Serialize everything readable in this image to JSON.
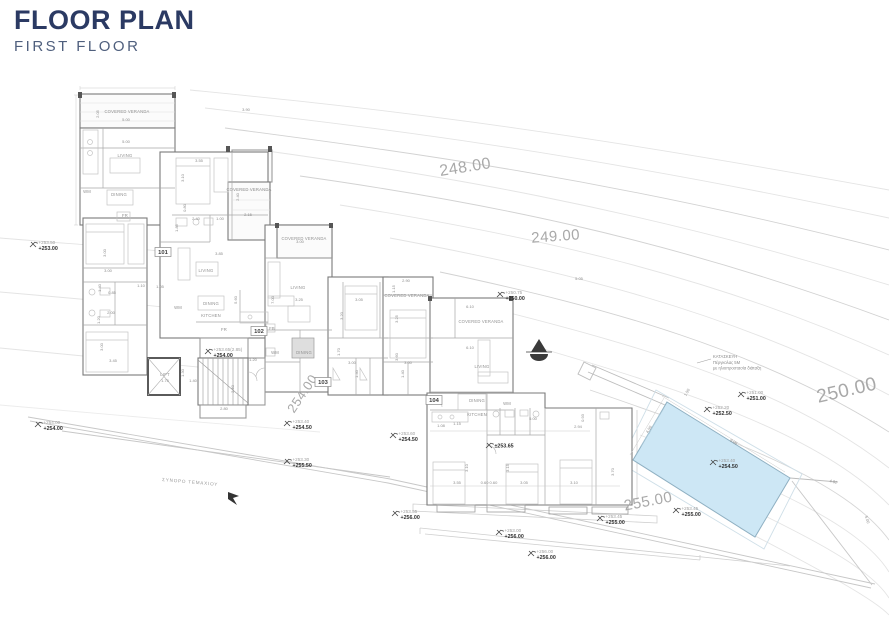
{
  "header": {
    "title": "FLOOR PLAN",
    "subtitle": "FIRST FLOOR"
  },
  "colors": {
    "title": "#2b3a63",
    "subtitle": "#4f5f7d",
    "pool_fill": "#cde7f5",
    "pool_stroke": "#8fb0c2",
    "contour_line": "#e2e2e2",
    "contour_label": "#a9a9a9",
    "wall": "#7a7a7a",
    "spot_existing": "#9e9e9e",
    "spot_proposed": "#2f2f2f",
    "annotation_gray": "#8f8f8f"
  },
  "plan": {
    "contour_labels": [
      {
        "text": "248.00",
        "x": 466,
        "y": 172,
        "rot": -9,
        "size": 16
      },
      {
        "text": "249.00",
        "x": 556,
        "y": 241,
        "rot": -4,
        "size": 15
      },
      {
        "text": "250.00",
        "x": 848,
        "y": 396,
        "rot": -13,
        "size": 19
      },
      {
        "text": "254.00",
        "x": 306,
        "y": 396,
        "rot": -56,
        "size": 13
      },
      {
        "text": "255.00",
        "x": 649,
        "y": 506,
        "rot": -11,
        "size": 15
      }
    ],
    "unit_labels": [
      {
        "text": "101",
        "x": 163,
        "y": 254
      },
      {
        "text": "102",
        "x": 259,
        "y": 333
      },
      {
        "text": "103",
        "x": 323,
        "y": 384
      },
      {
        "text": "104",
        "x": 434,
        "y": 402
      }
    ],
    "room_labels": [
      {
        "text": "COVERED VERANDA",
        "x": 127,
        "y": 113
      },
      {
        "text": "LIVING",
        "x": 125,
        "y": 157
      },
      {
        "text": "DINING",
        "x": 119,
        "y": 196
      },
      {
        "text": "COVERED VERANDA",
        "x": 249,
        "y": 191
      },
      {
        "text": "LIVING",
        "x": 206,
        "y": 272
      },
      {
        "text": "DINING",
        "x": 211,
        "y": 305
      },
      {
        "text": "KITCHEN",
        "x": 211,
        "y": 317
      },
      {
        "text": "COVERED VERANDA",
        "x": 304,
        "y": 240
      },
      {
        "text": "LIVING",
        "x": 298,
        "y": 289
      },
      {
        "text": "DINING",
        "x": 304,
        "y": 354
      },
      {
        "text": "COVERED VERANDA",
        "x": 407,
        "y": 297
      },
      {
        "text": "COVERED VERANDA",
        "x": 481,
        "y": 323
      },
      {
        "text": "LIVING",
        "x": 482,
        "y": 368
      },
      {
        "text": "DINING",
        "x": 477,
        "y": 402
      },
      {
        "text": "KITCHEN",
        "x": 477,
        "y": 416
      },
      {
        "text": "LIFT",
        "x": 165,
        "y": 376
      },
      {
        "text": "WM",
        "x": 87,
        "y": 193
      },
      {
        "text": "FR",
        "x": 125,
        "y": 217
      },
      {
        "text": "WM",
        "x": 178,
        "y": 309
      },
      {
        "text": "FR",
        "x": 224,
        "y": 331
      },
      {
        "text": "FB",
        "x": 272,
        "y": 330
      },
      {
        "text": "WM",
        "x": 275,
        "y": 354
      },
      {
        "text": "WM",
        "x": 507,
        "y": 405
      }
    ],
    "dimension_labels": [
      {
        "text": "5.00",
        "x": 126,
        "y": 121
      },
      {
        "text": "5.00",
        "x": 126,
        "y": 143
      },
      {
        "text": "2.05",
        "x": 99,
        "y": 114,
        "rot": -90
      },
      {
        "text": "3.90",
        "x": 246,
        "y": 111
      },
      {
        "text": "3.55",
        "x": 199,
        "y": 162
      },
      {
        "text": "3.10",
        "x": 184,
        "y": 178,
        "rot": -90
      },
      {
        "text": "2.40",
        "x": 239,
        "y": 197,
        "rot": -90
      },
      {
        "text": "2.15",
        "x": 248,
        "y": 216
      },
      {
        "text": "2.40",
        "x": 196,
        "y": 220
      },
      {
        "text": "1.00",
        "x": 220,
        "y": 220
      },
      {
        "text": "1.85",
        "x": 178,
        "y": 228,
        "rot": -90
      },
      {
        "text": "0.80",
        "x": 186,
        "y": 208,
        "rot": -90
      },
      {
        "text": "3.85",
        "x": 219,
        "y": 255
      },
      {
        "text": "3.00",
        "x": 106,
        "y": 253,
        "rot": -90
      },
      {
        "text": "3.00",
        "x": 108,
        "y": 272
      },
      {
        "text": "1.40",
        "x": 101,
        "y": 288,
        "rot": -90
      },
      {
        "text": "0.85",
        "x": 112,
        "y": 294
      },
      {
        "text": "1.20",
        "x": 100,
        "y": 320,
        "rot": -90
      },
      {
        "text": "2.00",
        "x": 111,
        "y": 314
      },
      {
        "text": "3.45",
        "x": 113,
        "y": 362
      },
      {
        "text": "3.00",
        "x": 103,
        "y": 347,
        "rot": -90
      },
      {
        "text": "1.10",
        "x": 141,
        "y": 287
      },
      {
        "text": "1.05",
        "x": 160,
        "y": 288
      },
      {
        "text": "5.60",
        "x": 237,
        "y": 300,
        "rot": -90
      },
      {
        "text": "3.00",
        "x": 300,
        "y": 243
      },
      {
        "text": "3.25",
        "x": 299,
        "y": 301
      },
      {
        "text": "7.00",
        "x": 274,
        "y": 300,
        "rot": -90
      },
      {
        "text": "3.05",
        "x": 359,
        "y": 301
      },
      {
        "text": "3.20",
        "x": 343,
        "y": 316,
        "rot": -90
      },
      {
        "text": "2.90",
        "x": 406,
        "y": 282
      },
      {
        "text": "1.15",
        "x": 395,
        "y": 289,
        "rot": -90
      },
      {
        "text": "3.25",
        "x": 398,
        "y": 319,
        "rot": -90
      },
      {
        "text": "1.70",
        "x": 340,
        "y": 352,
        "rot": -90
      },
      {
        "text": "3.60",
        "x": 398,
        "y": 357,
        "rot": -90
      },
      {
        "text": "3.00",
        "x": 352,
        "y": 364
      },
      {
        "text": "1.40",
        "x": 358,
        "y": 374,
        "rot": -90
      },
      {
        "text": "3.00",
        "x": 408,
        "y": 364
      },
      {
        "text": "1.40",
        "x": 404,
        "y": 374,
        "rot": -90
      },
      {
        "text": "2.50",
        "x": 234,
        "y": 389,
        "rot": -90
      },
      {
        "text": "2.80",
        "x": 224,
        "y": 410
      },
      {
        "text": "1.40",
        "x": 193,
        "y": 382
      },
      {
        "text": "1.75",
        "x": 165,
        "y": 382
      },
      {
        "text": "1.30",
        "x": 184,
        "y": 373,
        "rot": -90
      },
      {
        "text": "1.20",
        "x": 253,
        "y": 361
      },
      {
        "text": "6.10",
        "x": 470,
        "y": 308
      },
      {
        "text": "6.10",
        "x": 470,
        "y": 349
      },
      {
        "text": "5.05",
        "x": 579,
        "y": 280
      },
      {
        "text": "5.00",
        "x": 533,
        "y": 420
      },
      {
        "text": "2.94",
        "x": 578,
        "y": 428
      },
      {
        "text": "0.93",
        "x": 584,
        "y": 418,
        "rot": -90
      },
      {
        "text": "1.08",
        "x": 441,
        "y": 427
      },
      {
        "text": "1.15",
        "x": 457,
        "y": 425
      },
      {
        "text": "3.55",
        "x": 457,
        "y": 484
      },
      {
        "text": "0.60 0.60",
        "x": 489,
        "y": 484
      },
      {
        "text": "3.05",
        "x": 524,
        "y": 484
      },
      {
        "text": "3.10",
        "x": 574,
        "y": 484
      },
      {
        "text": "3.70",
        "x": 614,
        "y": 472,
        "rot": -90
      },
      {
        "text": "3.15",
        "x": 509,
        "y": 468,
        "rot": -90
      },
      {
        "text": "3.10",
        "x": 468,
        "y": 468,
        "rot": -90
      },
      {
        "text": "9.00",
        "x": 733,
        "y": 443,
        "rot": 31
      },
      {
        "text": "4.50",
        "x": 650,
        "y": 430,
        "rot": -60
      },
      {
        "text": "1.50",
        "x": 688,
        "y": 393,
        "rot": -60
      },
      {
        "text": "4.92",
        "x": 833,
        "y": 483,
        "rot": 14
      },
      {
        "text": "5.00",
        "x": 866,
        "y": 520,
        "rot": 72
      }
    ],
    "spot_elevations": [
      {
        "x": 33,
        "y": 245,
        "existing": "+253.50",
        "proposed": "+253.00"
      },
      {
        "x": 38,
        "y": 425,
        "existing": "+254.00",
        "proposed": "+254.00"
      },
      {
        "x": 208,
        "y": 352,
        "existing": "+253.65(2.85)",
        "proposed": "+254.00"
      },
      {
        "x": 500,
        "y": 295,
        "existing": "+250.75",
        "proposed": "+250.00"
      },
      {
        "x": 287,
        "y": 424,
        "existing": "+253.40",
        "proposed": "+254.50"
      },
      {
        "x": 393,
        "y": 436,
        "existing": "+253.60",
        "proposed": "+254.50"
      },
      {
        "x": 287,
        "y": 462,
        "existing": "+253.30",
        "proposed": "+255.50"
      },
      {
        "x": 489,
        "y": 446,
        "existing": "",
        "proposed": "±253.65"
      },
      {
        "x": 741,
        "y": 395,
        "existing": "+251.00",
        "proposed": "+251.00"
      },
      {
        "x": 707,
        "y": 410,
        "existing": "+252.20",
        "proposed": "+252.50"
      },
      {
        "x": 713,
        "y": 463,
        "existing": "+253.40",
        "proposed": "+254.50"
      },
      {
        "x": 676,
        "y": 511,
        "existing": "+253.45",
        "proposed": "+255.00"
      },
      {
        "x": 600,
        "y": 519,
        "existing": "+253.45",
        "proposed": "+255.00"
      },
      {
        "x": 395,
        "y": 514,
        "existing": "+253.55",
        "proposed": "+256.00"
      },
      {
        "x": 499,
        "y": 533,
        "existing": "+253.00",
        "proposed": "+256.00"
      },
      {
        "x": 531,
        "y": 554,
        "existing": "+256.00",
        "proposed": "+256.00"
      }
    ],
    "notes": {
      "pool_note": {
        "x": 713,
        "y": 358,
        "lines": [
          "ΚΑΤΑΣΚΕΥΗ",
          "Πέργκολας 5Μ",
          "με ηλιοπροστασία διάταξη"
        ]
      },
      "boundary_label": {
        "text": "ΣΥΝΟΡΟ ΤΕΜΑΧΙΟΥ",
        "x": 162,
        "y": 481,
        "rot": 5
      }
    }
  }
}
